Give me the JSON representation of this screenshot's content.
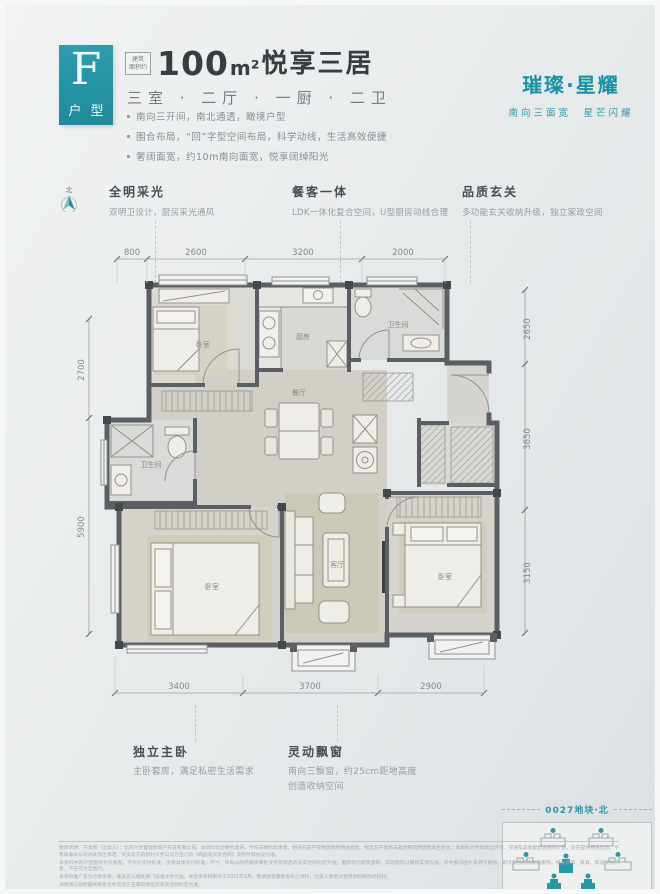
{
  "colors": {
    "teal": "#2693a3",
    "wall": "#5b5f63",
    "text_dark": "#383d42",
    "text_gray": "#878d93"
  },
  "header": {
    "type_letter": "F",
    "type_label": "户型",
    "area_tag_line1": "建筑",
    "area_tag_line2": "面积约",
    "area_number": "100",
    "area_unit": "m²",
    "title_suffix": "悦享三居",
    "layout_line": "三室 · 二厅 · 一厨 · 二卫",
    "bullets": [
      "南向三开间，南北通透，瞰境户型",
      "围合布局，“回”字型空间布局，科学动线，生活高效便捷",
      "奢阔面宽，约10m南向面宽，悦享阔绰阳光"
    ]
  },
  "brand": {
    "name": "璀璨·星耀",
    "slogan": "南向三面宽　星芒闪耀"
  },
  "compass": {
    "label": "北"
  },
  "features": [
    {
      "title": "全明采光",
      "desc": "双明卫设计，厨房采光通风"
    },
    {
      "title": "餐客一体",
      "desc": "LDK一体化复合空间，U型厨房动线合理"
    },
    {
      "title": "品质玄关",
      "desc": "多功能玄关收纳升级，独立家政空间"
    }
  ],
  "floorplan": {
    "dims_top": [
      "800",
      "2600",
      "3200",
      "2000"
    ],
    "dims_left": [
      "2700",
      "5900"
    ],
    "dims_right": [
      "2650",
      "3650",
      "3150"
    ],
    "dims_bottom": [
      "3400",
      "3700",
      "2900"
    ],
    "rooms": {
      "bedroom_a": "卧室",
      "kitchen": "厨房",
      "bath_a": "卫生间",
      "dining": "餐厅",
      "bath_b": "卫生间",
      "living": "客厅",
      "master": "卧室",
      "bedroom_c": "卧室"
    }
  },
  "notes": [
    {
      "title": "独立主卧",
      "desc": "主卧套房，满足私密生活需求"
    },
    {
      "title": "灵动飘窗",
      "desc": "南向三飘窗，约25cm距地高度",
      "desc2": "创造收纳空间"
    }
  ],
  "sitemap": {
    "title": "0027地块·北"
  },
  "disclaimer": {
    "lines": [
      "免责声明：开发商（出卖人）：北京兴创置地房地产开发有限公司。本资料仅为要约邀请，不构成要约或承诺，相关内容不排除因政府相关规划、规定及开发商未能控制的原因而发生变化。本资料对项目周边环境、交通及其他配套设施的介绍，旨在提供相关信息，不意味着本公司对此作出承诺。买卖双方的权利义务以双方签订的《商品房买卖合同》及附件等协议为准。",
      "本资料中的户型图仅为示意图，不作为交付标准，房屋具体交付标准、尺寸、布局以政府最终审批文件及商品房买卖合同约定为准；面积均为建筑面积，实际面积以最终实测为准。文中部分图片来源于网络，如涉及侵权请联系删除。相关装饰、家具、陈设仅为示意，不在交付范围内。",
      "本项目推广名为示意名称，备案名以相关部门核准文件为准。本宣传资料制作于2021年9月，敬请留意最新发布之资料，出卖人保留对宣传资料修改的权利。",
      "详情请以政府最终审批文件及双方签署的商品房买卖合同约定为准。"
    ]
  }
}
